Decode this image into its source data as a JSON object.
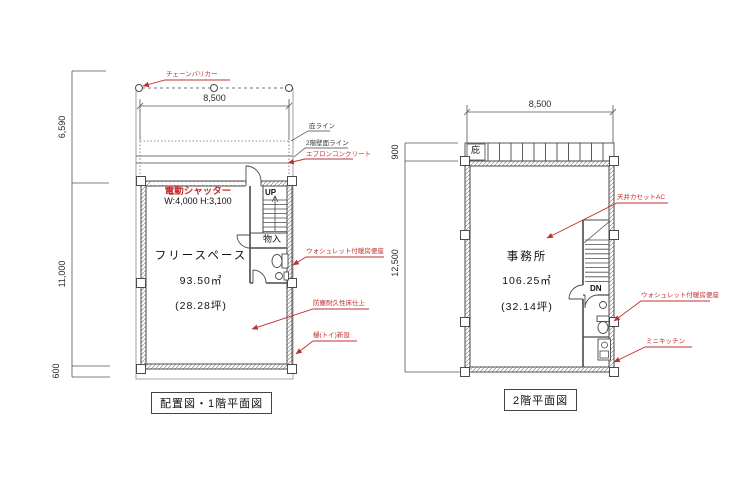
{
  "colors": {
    "annotation_red": "#c03030",
    "line": "#4a4a4a"
  },
  "plan1": {
    "caption": "配置図・1階平面図",
    "dims": {
      "top": "8,500",
      "left_upper": "6,590",
      "left_middle": "11,000",
      "left_lower": "600"
    },
    "labels": {
      "chain_barrier": "チェーンバリカー",
      "eave_line": "庇ライン",
      "second_floor_wall_line": "2階壁面ライン",
      "apron_concrete": "エプロンコンクリート",
      "electric_shutter": "電動シャッター",
      "shutter_size": "W:4,000 H:3,100",
      "up": "UP",
      "storage": "物入",
      "room_name": "フリースペース",
      "area_m2": "93.50㎡",
      "area_tsubo": "(28.28坪)",
      "washlet": "ウォシュレット付暖房便座",
      "floor_finish": "防塵耐久性床仕上",
      "downspout": "樋(トイ)新設"
    }
  },
  "plan2": {
    "caption": "2階平面図",
    "dims": {
      "top": "8,500",
      "left_upper": "900",
      "left_middle": "12,500"
    },
    "labels": {
      "eave": "庇",
      "ceiling_ac": "天井カセットAC",
      "room_name": "事務所",
      "area_m2": "106.25㎡",
      "area_tsubo": "(32.14坪)",
      "down": "DN",
      "washlet": "ウォシュレット付暖房便座",
      "mini_kitchen": "ミニキッチン"
    }
  }
}
